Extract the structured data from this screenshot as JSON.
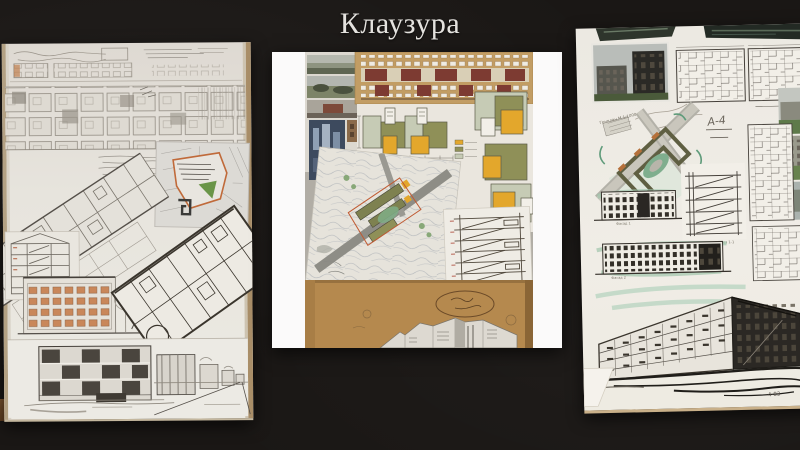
{
  "slide": {
    "title": "Клаузура"
  },
  "palette": {
    "background": "#1a1715",
    "title_text": "#e4e2de",
    "paper": "#eceae3",
    "kraft_paper": "#b5894e",
    "tan_sheet": "#c49f66",
    "maroon_accent": "#7b3a31",
    "plan_olive": "#8d8e56",
    "plan_sage": "#c4c9b3",
    "plan_yellow": "#e4a72e",
    "teal_marker": "#8fbf9f",
    "site_outline_orange": "#c05a32",
    "park_green": "#6a9548"
  },
  "right_board": {
    "genplan_label": "Генплан М 1:1000",
    "plan_mark": "А-4",
    "section_label": "Разрез 1-1",
    "facade1_label": "Фасад 1",
    "facade2_label": "Фасад 2",
    "signature": "4-83"
  }
}
